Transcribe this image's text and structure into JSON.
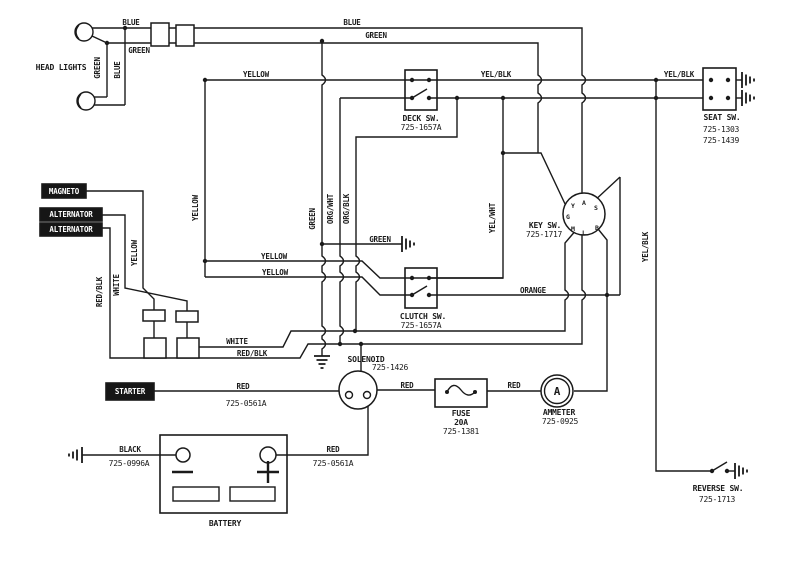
{
  "components": {
    "head_lights": {
      "label": "HEAD LIGHTS"
    },
    "magneto": {
      "label": "MAGNETO"
    },
    "alternator_a": {
      "label": "ALTERNATOR"
    },
    "alternator_b": {
      "label": "ALTERNATOR"
    },
    "deck_switch": {
      "label": "DECK SW.",
      "part": "725-1657A"
    },
    "clutch_switch": {
      "label": "CLUTCH SW.",
      "part": "725-1657A"
    },
    "seat_switch": {
      "label": "SEAT SW.",
      "parts": [
        "725-1303",
        "725-1439"
      ]
    },
    "key_switch": {
      "label": "KEY SW.",
      "part": "725-1717",
      "terminals": [
        "Y",
        "A",
        "S",
        "G",
        "M",
        "L",
        "B"
      ]
    },
    "reverse_switch": {
      "label": "REVERSE SW.",
      "part": "725-1713"
    },
    "solenoid": {
      "label": "SOLENOID",
      "part": "725-1426"
    },
    "fuse": {
      "label": "FUSE",
      "rating": "20A",
      "part": "725-1381"
    },
    "ammeter": {
      "label": "AMMETER",
      "part": "725-0925",
      "symbol": "A"
    },
    "starter": {
      "label": "STARTER"
    },
    "battery": {
      "label": "BATTERY",
      "minus": "-",
      "plus": "+"
    }
  },
  "wire_labels": {
    "blue_headlight": "BLUE",
    "blue_main": "BLUE",
    "blue_vertical": "BLUE",
    "green_headlight": "GREEN",
    "green_main": "GREEN",
    "green_vertical": "GREEN",
    "green_ground_vertical": "GREEN",
    "green_ground": "GREEN",
    "yellow_main": "YELLOW",
    "yellow_left_vertical": "YELLOW",
    "yellow_magneto_vertical": "YELLOW",
    "yellow_mid_upper": "YELLOW",
    "yellow_mid_lower": "YELLOW",
    "yel_blk_deck": "YEL/BLK",
    "yel_blk_seat": "YEL/BLK",
    "yel_blk_vertical": "YEL/BLK",
    "yel_wht_vertical": "YEL/WHT",
    "org_wht_vertical": "ORG/WHT",
    "org_blk_vertical": "ORG/BLK",
    "orange": "ORANGE",
    "white_vertical": "WHITE",
    "white_main": "WHITE",
    "red_blk_vertical": "RED/BLK",
    "red_blk_main": "RED/BLK",
    "red_starter": "RED",
    "part_starter": "725-0561A",
    "red_fuse": "RED",
    "red_ammeter": "RED",
    "red_battery": "RED",
    "part_battery_red": "725-0561A",
    "black_battery": "BLACK",
    "part_battery_black": "725-0996A"
  }
}
